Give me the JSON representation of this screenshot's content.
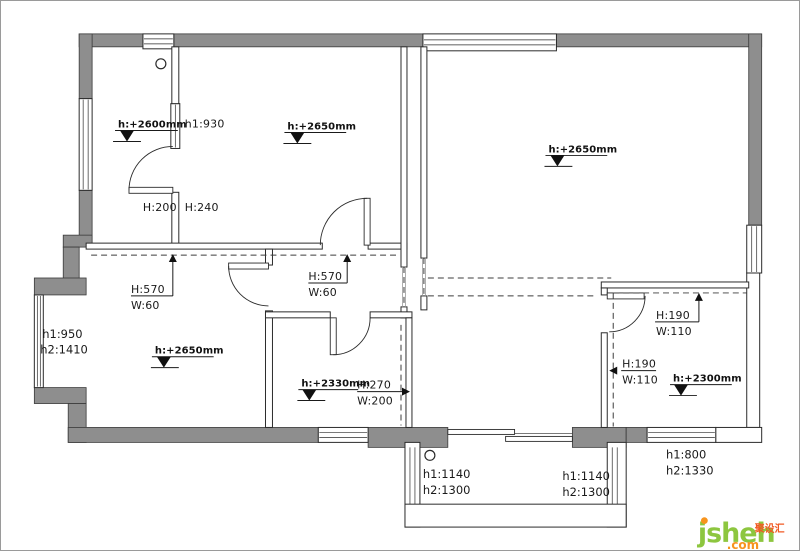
{
  "t": {
    "elev_room1": "h:+2600mm",
    "win_room1": "h1:930",
    "door_room1": "H:200",
    "door_room2": "H:240",
    "elev_room2": "h:+2650mm",
    "elev_bigroom": "h:+2650mm",
    "elev_living": "h:+2650mm",
    "beam1_h": "H:570",
    "beam1_w": "W:60",
    "beam2_h": "H:570",
    "beam2_w": "W:60",
    "baywin1": "h1:950",
    "baywin2": "h2:1410",
    "elev_bath": "h:+2330mm",
    "beam3_h": "H:270",
    "beam3_w": "W:200",
    "beam4_h": "H:190",
    "beam4_w": "W:110",
    "beam5_h": "H:190",
    "beam5_w": "W:110",
    "elev_bed": "h:+2300mm",
    "win_bed1": "h1:800",
    "win_bed2": "h2:1330",
    "balc_l1": "h1:1140",
    "balc_l2": "h2:1300",
    "balc_r1": "h1:1140",
    "balc_r2": "h2:1300"
  },
  "watermark": {
    "brand": "jsheh",
    "suffix": ".com",
    "chinese": "聚设汇"
  },
  "colors": {
    "wall_gray": "#8e8e8e",
    "line_dark": "#2b2b2b",
    "brand_green": "#8dc63f",
    "brand_orange": "#f7941d",
    "brand_red": "#f15a24"
  }
}
